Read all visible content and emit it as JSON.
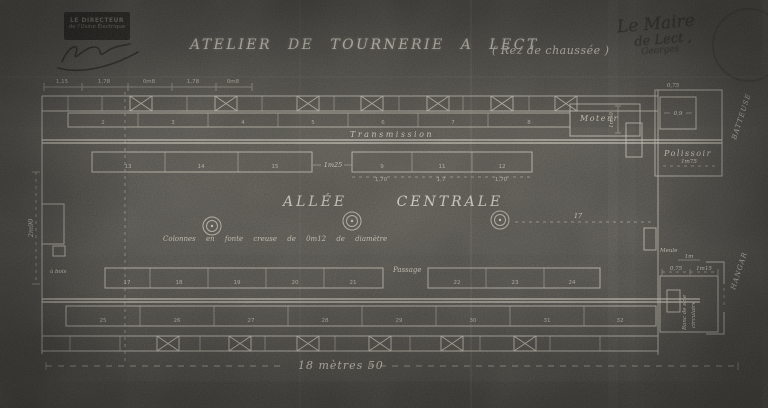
{
  "header": {
    "title": "ATELIER DE TOURNERIE A LECT",
    "subtitle": "( Rez de chaussée )",
    "director_stamp": {
      "line1": "LE DIRECTEUR",
      "line2": "de l'Usine Électrique"
    },
    "mayor_note": {
      "line1": "Le Maire",
      "line2": "de Lect ,",
      "line3": "Georges"
    }
  },
  "plan": {
    "labels": {
      "transmission": "Transmission",
      "allee_centrale": "ALLÉE CENTRALE",
      "colonnes_note": "Colonnes en fonte creuse de 0m12 de diamètre",
      "passage": "Passage",
      "moteur": "Moteur",
      "polissoir": "Polissoir",
      "batteuse": "BATTEUSE",
      "hangar": "HANGAR",
      "meule": "Meule",
      "banc_de_scie_line1": "Banc de scie",
      "banc_de_scie_line2": "circulaire",
      "a_bois": "à bois"
    },
    "dims": {
      "overall_length": "18 mètres 50",
      "left_width": "2m90",
      "aisle_gap": "1m25",
      "center_span": "17",
      "moteur_height": "1m50",
      "polissoir_width": "1m75",
      "annex_top": "0,75",
      "annex_inner": "0,9",
      "saw_dim_a": "0,75",
      "saw_dim_b": "1m15",
      "saw_dim_c": "1m",
      "top_dims": [
        {
          "t": "1,15",
          "x": 62
        },
        {
          "t": "1,78",
          "x": 104
        },
        {
          "t": "0m8",
          "x": 149
        },
        {
          "t": "1,78",
          "x": 193
        },
        {
          "t": "0m8",
          "x": 233
        }
      ],
      "row2_dims": [
        {
          "t": "1,70",
          "x": 381
        },
        {
          "t": "1,7",
          "x": 441
        },
        {
          "t": "1,70",
          "x": 501
        }
      ]
    },
    "machines": {
      "row1": {
        "y": 124,
        "items": [
          {
            "n": "2",
            "x": 103
          },
          {
            "n": "3",
            "x": 173
          },
          {
            "n": "4",
            "x": 243
          },
          {
            "n": "5",
            "x": 313
          },
          {
            "n": "6",
            "x": 383
          },
          {
            "n": "7",
            "x": 453
          },
          {
            "n": "8",
            "x": 529
          }
        ]
      },
      "row2_left": {
        "y": 168,
        "items": [
          {
            "n": "13",
            "x": 128
          },
          {
            "n": "14",
            "x": 201
          },
          {
            "n": "15",
            "x": 275
          }
        ]
      },
      "row2_right": {
        "y": 168,
        "items": [
          {
            "n": "9",
            "x": 382
          },
          {
            "n": "11",
            "x": 442
          },
          {
            "n": "12",
            "x": 502
          }
        ]
      },
      "row3_left": {
        "y": 284,
        "items": [
          {
            "n": "17",
            "x": 127
          },
          {
            "n": "18",
            "x": 179
          },
          {
            "n": "19",
            "x": 237
          },
          {
            "n": "20",
            "x": 295
          },
          {
            "n": "21",
            "x": 353
          }
        ]
      },
      "row3_right": {
        "y": 284,
        "items": [
          {
            "n": "22",
            "x": 457
          },
          {
            "n": "23",
            "x": 515
          },
          {
            "n": "24",
            "x": 572
          }
        ]
      },
      "row4": {
        "y": 322,
        "items": [
          {
            "n": "25",
            "x": 103
          },
          {
            "n": "26",
            "x": 177
          },
          {
            "n": "27",
            "x": 251
          },
          {
            "n": "28",
            "x": 325
          },
          {
            "n": "29",
            "x": 399
          },
          {
            "n": "30",
            "x": 473
          },
          {
            "n": "31",
            "x": 547
          },
          {
            "n": "32",
            "x": 620
          }
        ]
      }
    }
  }
}
